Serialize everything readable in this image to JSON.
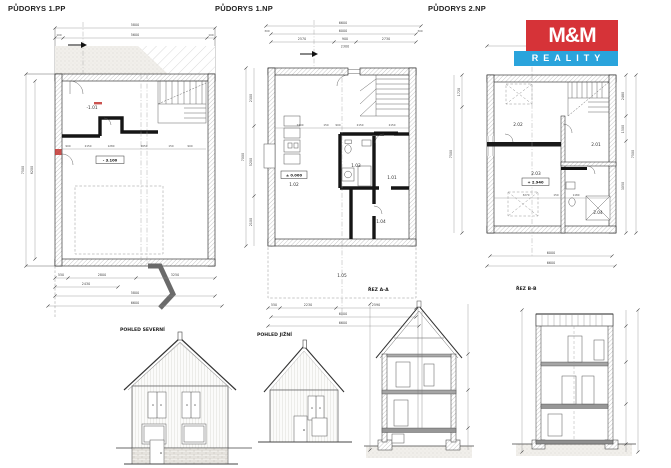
{
  "titles": {
    "pp": "PŮDORYS 1.PP",
    "np": "PŮDORYS 1.NP",
    "np2": "PŮDORYS 2.NP"
  },
  "logo": {
    "mm": "M&M",
    "reality": "REALITY",
    "red": "#d63338",
    "blue": "#2aa4dc"
  },
  "plan_pp": {
    "room": "-1.01",
    "level": "- 3.100",
    "dim_top_total": "5800",
    "dim_top_inner": "5600",
    "dim_top_small": "100",
    "dim_left_total": "7500",
    "dim_left_inner": "6200",
    "bottom_row1": [
      "550",
      "2800",
      "3250"
    ],
    "bottom_row2": "2430",
    "bottom_row3": "5800",
    "bottom_row4": "6600",
    "mid_dims": [
      "900",
      "2150",
      "1280",
      "2650",
      "150",
      "900"
    ]
  },
  "plan_np": {
    "rooms": {
      "r101": "1.01",
      "r102": "1.02",
      "r103": "1.03",
      "r104": "1.04",
      "r105": "1.05"
    },
    "level": "± 0.000",
    "dim_top_total": "6600",
    "dim_top_inner": "6000",
    "dim_top_small": "300",
    "top_row3": [
      "2570",
      "900",
      "2730"
    ],
    "top_row4": "2300",
    "left_total": "7000",
    "left_segs": [
      "2300",
      "5200",
      "2100"
    ],
    "bottom_row1": [
      "550",
      "2230",
      "2590"
    ],
    "bottom_row2": "6000",
    "bottom_row3": "6600",
    "mid_dims": [
      "2400",
      "150",
      "900",
      "2150",
      "2150"
    ]
  },
  "plan_np2": {
    "rooms": {
      "r201": "2.01",
      "r202": "2.02",
      "r203": "2.03",
      "r204": "2.04"
    },
    "level": "+ 2.940",
    "right_segs": [
      "2480",
      "1500",
      "3050"
    ],
    "right_total": "7500",
    "left_seg": "1720",
    "left_total": "7500",
    "bottom_row1": "6000",
    "bottom_row2": "6600",
    "mid_dims": [
      "3270",
      "150",
      "1180"
    ]
  },
  "views": {
    "north": "POHLED SEVERNÍ",
    "south": "POHLED JIŽNÍ"
  },
  "sections": {
    "a": "ŘEZ A-A",
    "b": "ŘEZ B-B"
  }
}
